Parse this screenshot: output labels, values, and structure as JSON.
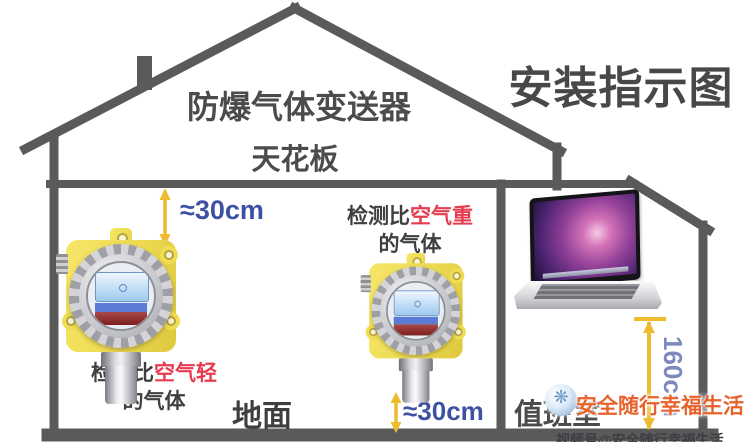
{
  "title": "安装指示图",
  "header": {
    "device_title": "防爆气体变送器",
    "ceiling_label": "天花板"
  },
  "floor_labels": {
    "ground": "地面",
    "duty_room": "值班室"
  },
  "dimensions": {
    "top_clearance": "≈30cm",
    "bottom_clearance": "≈30cm",
    "install_height": "160cm"
  },
  "notes": {
    "lighter": {
      "prefix": "检测比",
      "highlight": "空气轻",
      "suffix": "的气体"
    },
    "heavier": {
      "prefix": "检测比",
      "highlight": "空气重",
      "suffix": "的气体"
    }
  },
  "watermark": {
    "main": "安全随行幸福生活",
    "sub": "视频号@安全随行幸福生活",
    "logo_glyph": "❋"
  },
  "icons": {
    "watermark_logo": "video-channel-logo",
    "left_device": "gas-detector",
    "middle_device": "gas-detector",
    "annex_device": "laptop-monitor"
  },
  "colors": {
    "outline_gray": "#5a5a5a",
    "arrow_yellow": "#eebb2e",
    "dimension_blue": "#3f51a3",
    "dimension_blue_light": "#7d89bd",
    "highlight_red": "#e63c52",
    "text_dark": "#3f3f3f",
    "watermark_orange": "#e8632c",
    "detector_yellow": "#f2df55"
  }
}
